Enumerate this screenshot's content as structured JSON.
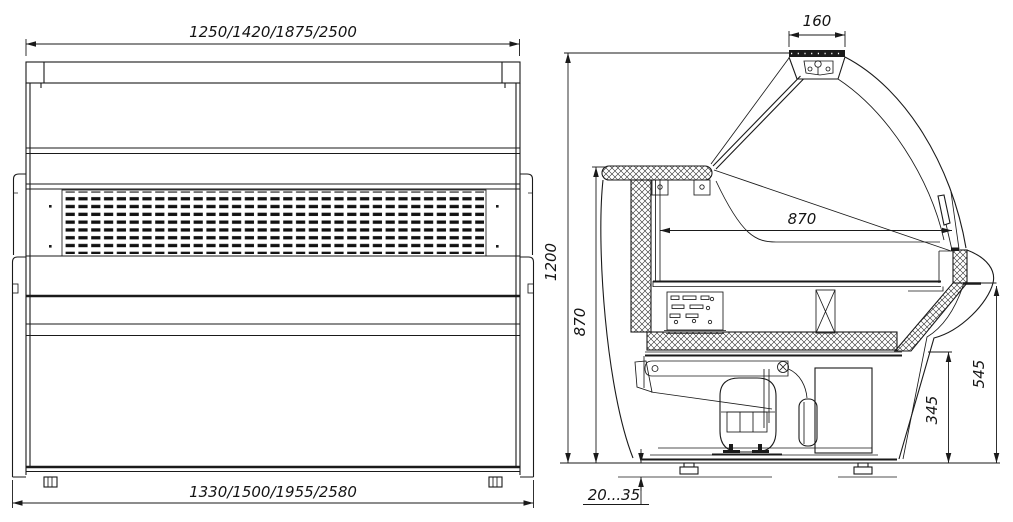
{
  "drawing": {
    "front_view": {
      "top_width": "1250/1420/1875/2500",
      "bottom_width": "1330/1500/1955/2580"
    },
    "side_view": {
      "canopy_width": "160",
      "overall_height": "1200",
      "back_height": "870",
      "display_depth": "870",
      "glass_sill_height": "545",
      "front_panel_height": "345",
      "leg_adjust_range": "20...35"
    }
  }
}
